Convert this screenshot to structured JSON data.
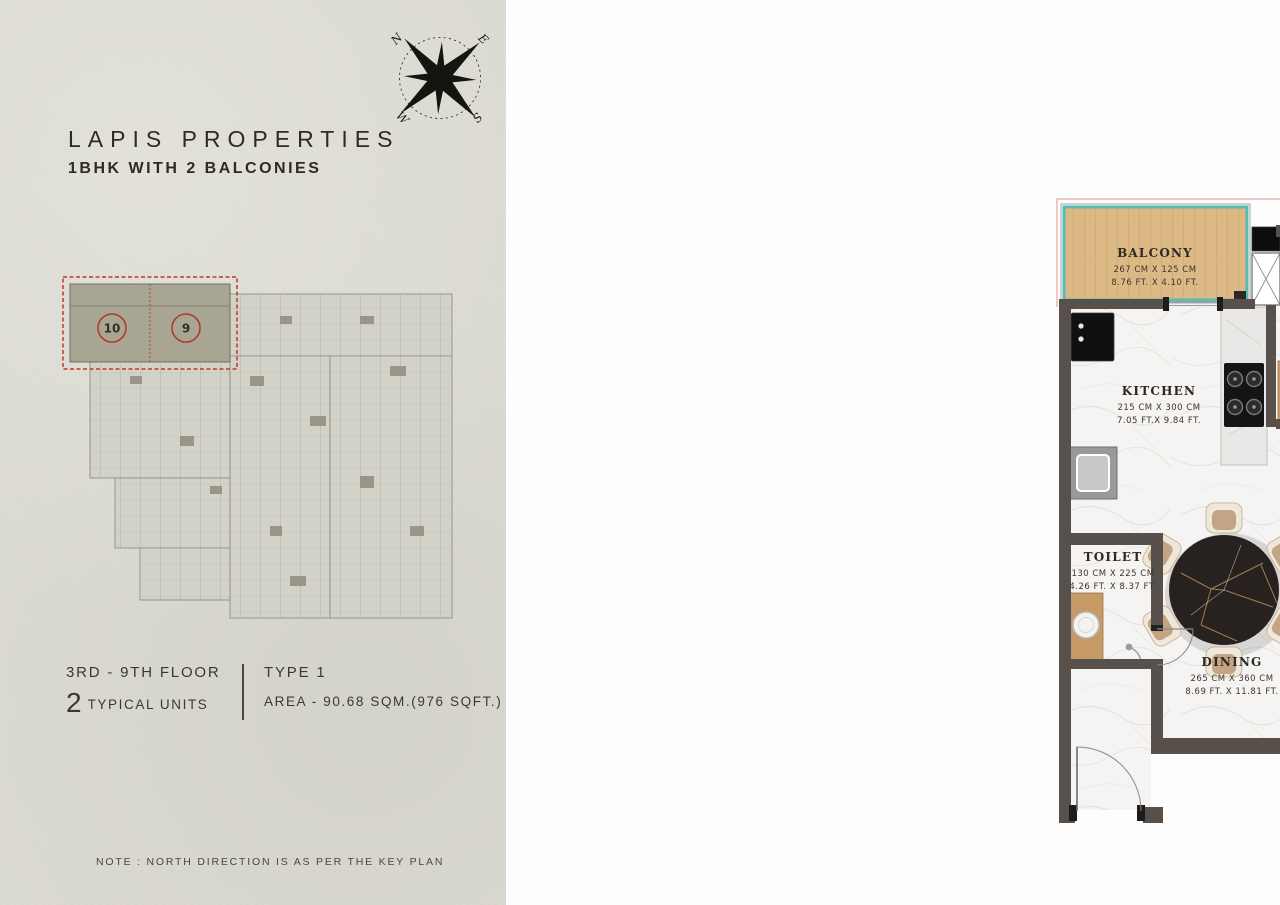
{
  "left_panel": {
    "title": "LAPIS PROPERTIES",
    "subtitle": "1BHK WITH 2 BALCONIES",
    "compass": {
      "n": "N",
      "e": "E",
      "s": "S",
      "w": "W"
    },
    "key_plan": {
      "unit_left": "10",
      "unit_right": "9"
    },
    "floor_info": {
      "floor_range": "3RD - 9TH FLOOR",
      "units_count": "2",
      "units_label": "TYPICAL UNITS",
      "type_label": "TYPE 1",
      "area_label": "AREA - 90.68 SQM.(976 SQFT.)"
    },
    "note": "NOTE : NORTH DIRECTION IS AS PER THE KEY PLAN"
  },
  "right_panel": {
    "logo_text": "LAPIS",
    "rooms": {
      "balcony_top": {
        "name": "BALCONY",
        "cm": "267 CM X 125 CM",
        "ft": "8.76 FT. X 4.10 FT."
      },
      "kitchen": {
        "name": "KITCHEN",
        "cm": "215 CM X 300 CM",
        "ft": "7.05 FT.X 9.84 FT."
      },
      "toilet_top": {
        "name": "TOILET",
        "cm": "170 CM X 250 CM",
        "ft": "5.58 FT. X 8.20 FT."
      },
      "bedroom": {
        "name": "BEDROOM",
        "cm": "415 CM X 420 CM",
        "ft": "13.61 FT. X 13.78 FT."
      },
      "toilet_bottom": {
        "name": "TOILET",
        "cm": "130 CM X 225 CM",
        "ft": "4.26 FT. X 8.37 FT."
      },
      "dining": {
        "name": "DINING",
        "cm": "265 CM X 360 CM",
        "ft": "8.69 FT. X 11.81 FT."
      },
      "living": {
        "name": "LIVING ROOM",
        "cm": "410 CM X 360 CM",
        "ft": "13.45 FT. X 11.81 FT."
      },
      "balcony_right": {
        "name": "BALCONY",
        "cm": "205 CM X 165 CM",
        "ft": "6.73 FT. X 15.41 FT."
      },
      "pool": {
        "name": "POOL",
        "cm": "205 CM X 175 CM",
        "ft": "6.73 FT. X 5.74 FT."
      }
    }
  },
  "colors": {
    "accent_teal": "#57bcb4",
    "wall": "#57504b",
    "highlight_red": "#c1392b",
    "logo_gold": "#a8863f"
  }
}
